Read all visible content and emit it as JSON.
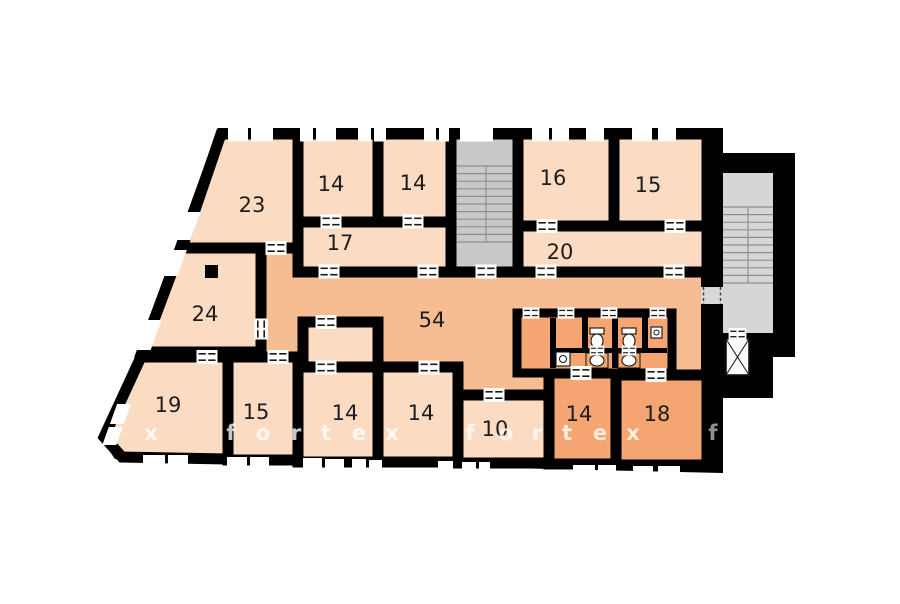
{
  "title": "apartment-floor-plan",
  "colors": {
    "wall": "#000000",
    "room_light": "#fbdcc3",
    "corridor": "#f6bd92",
    "room_dark": "#f4a571",
    "stair": "#c9c9c9",
    "stair_annex": "#d6d6d6",
    "window": "#ffffff",
    "label_text": "#1d1d1d"
  },
  "rooms": [
    {
      "id": "room-23",
      "label": "23"
    },
    {
      "id": "room-14-top-left",
      "label": "14"
    },
    {
      "id": "room-14-top-right",
      "label": "14"
    },
    {
      "id": "room-16",
      "label": "16"
    },
    {
      "id": "room-15-top",
      "label": "15"
    },
    {
      "id": "room-17",
      "label": "17"
    },
    {
      "id": "room-20",
      "label": "20"
    },
    {
      "id": "room-24",
      "label": "24"
    },
    {
      "id": "corridor-54",
      "label": "54"
    },
    {
      "id": "room-19",
      "label": "19"
    },
    {
      "id": "room-15-bottom",
      "label": "15"
    },
    {
      "id": "room-14-bottom-1",
      "label": "14"
    },
    {
      "id": "room-14-bottom-2",
      "label": "14"
    },
    {
      "id": "room-10",
      "label": "10"
    },
    {
      "id": "room-14-bottom-3",
      "label": "14"
    },
    {
      "id": "room-18",
      "label": "18"
    }
  ],
  "fixtures": [
    "main-staircase",
    "annex-staircase",
    "elevator",
    "toilet",
    "toilet",
    "sink",
    "sink",
    "washbasin",
    "hand-basin",
    "column"
  ],
  "watermark": {
    "letters": [
      {
        "ch": "x"
      },
      {
        "ch": "f"
      },
      {
        "ch": "o"
      },
      {
        "ch": "r"
      },
      {
        "ch": "t"
      },
      {
        "ch": "e"
      },
      {
        "ch": "x"
      },
      {
        "ch": "f"
      },
      {
        "ch": "o"
      },
      {
        "ch": "r"
      },
      {
        "ch": "t"
      },
      {
        "ch": "e"
      },
      {
        "ch": "x"
      },
      {
        "ch": "f"
      }
    ]
  }
}
